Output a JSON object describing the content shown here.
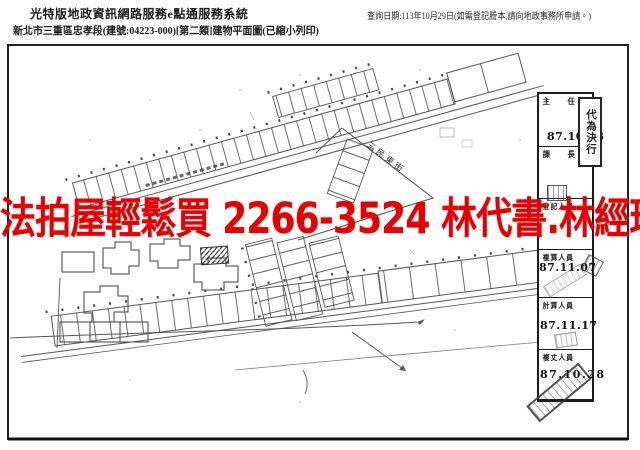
{
  "header": {
    "system_title": "光特版地政資訊網路服務e點通服務系統",
    "document_title": "新北市三重區忠孝段(建號:04223-000)[第二類]建物平面圖(已縮小列印)",
    "query_date": "查詢日期:113年10月29日(如需登記謄本,請向地政事務所申請。)"
  },
  "banner": {
    "text": "法拍屋輕鬆買 2266-3524 林代書.林經理",
    "color": "#e60000"
  },
  "map": {
    "road_label": "三民東街"
  },
  "approval_table": {
    "decision_stamp": "代為決行",
    "rows": [
      {
        "label": "主　　任",
        "date": "87.10.23"
      },
      {
        "label": "課　　長",
        "date": ""
      },
      {
        "label": "登記人員",
        "date": ""
      },
      {
        "label": "複算人員",
        "date": "87.11.07"
      },
      {
        "label": "計算人員",
        "date": "87.11.17"
      },
      {
        "label": "複丈人員",
        "date": "87.10.28"
      }
    ]
  }
}
